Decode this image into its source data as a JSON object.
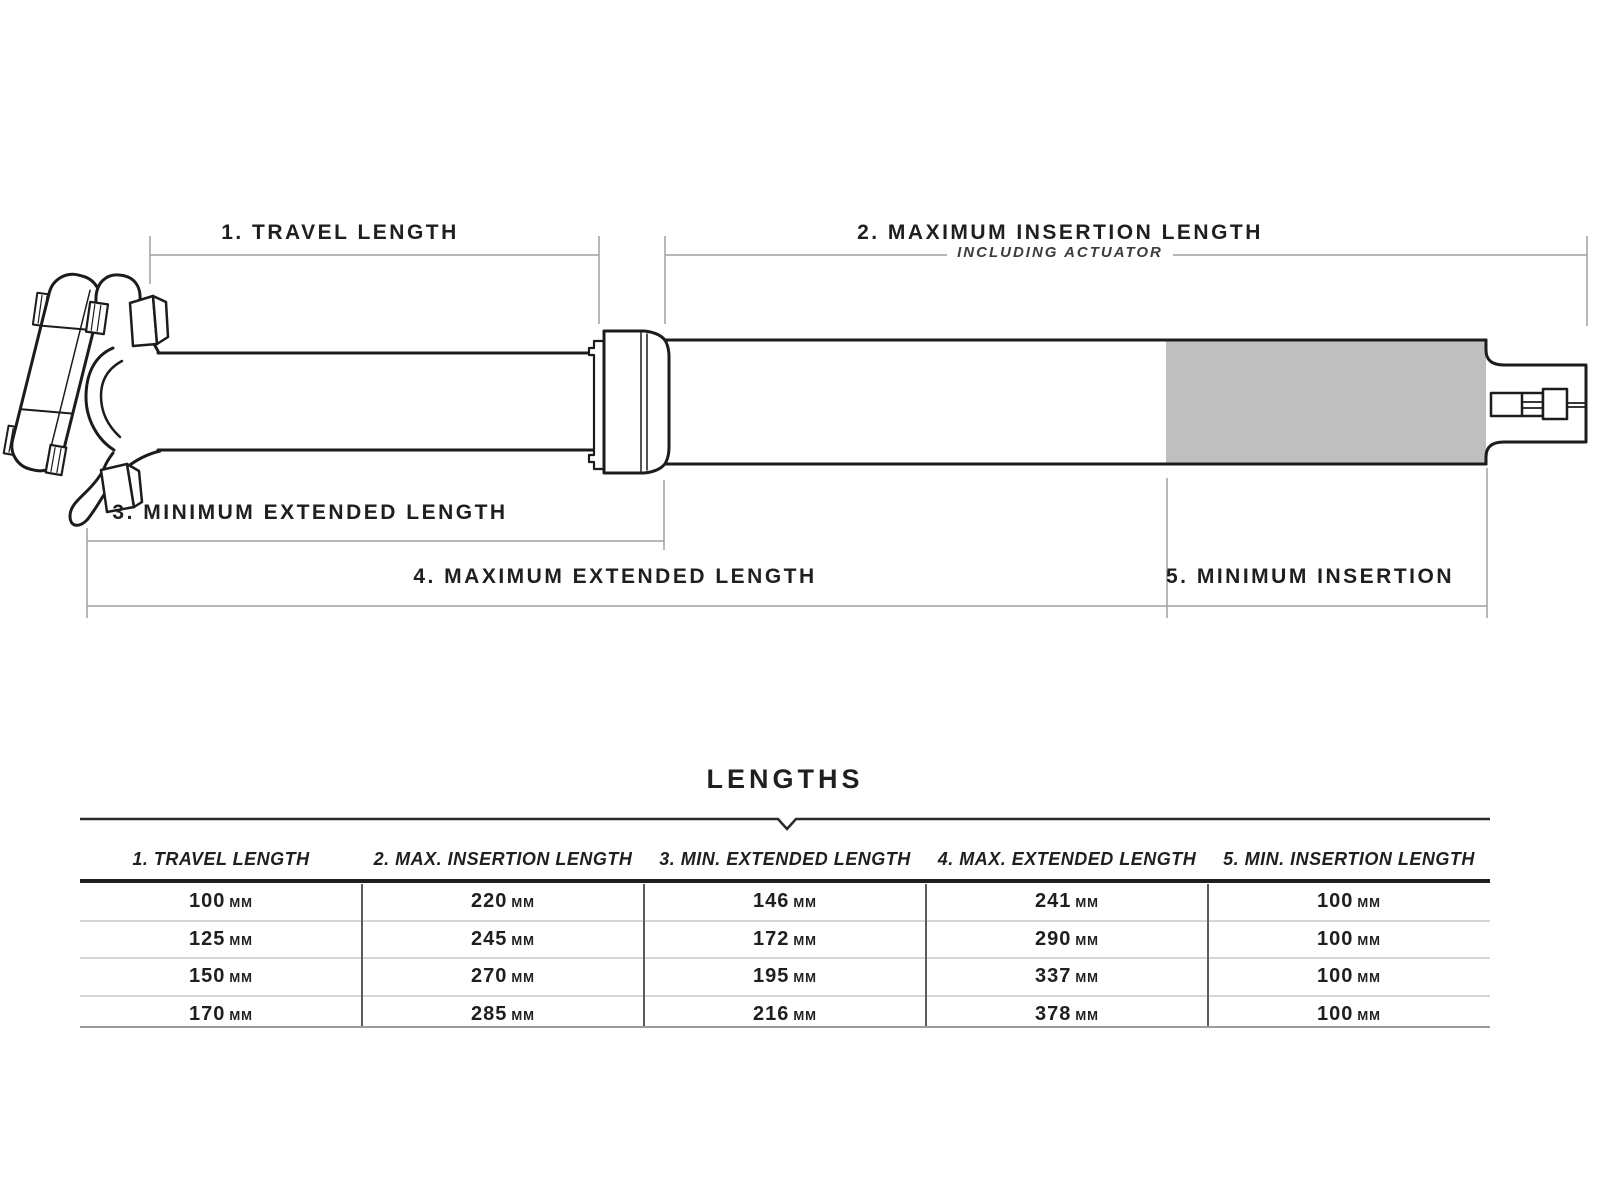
{
  "diagram": {
    "labels": {
      "travel": "1. TRAVEL LENGTH",
      "max_insertion": "2. MAXIMUM INSERTION LENGTH",
      "max_insertion_sub": "INCLUDING ACTUATOR",
      "min_extended": "3. MINIMUM EXTENDED LENGTH",
      "max_extended": "4. MAXIMUM EXTENDED LENGTH",
      "min_insertion": "5. MINIMUM INSERTION"
    },
    "colors": {
      "insertion_zone": "#bfbfbf",
      "outline": "#1c1c1c",
      "dimension_line": "#a0a0a0",
      "text": "#1f1f1f"
    }
  },
  "table": {
    "title": "LENGTHS",
    "unit": "MM",
    "headers": [
      "1. TRAVEL LENGTH",
      "2. MAX. INSERTION LENGTH",
      "3. MIN. EXTENDED LENGTH",
      "4. MAX. EXTENDED LENGTH",
      "5. MIN. INSERTION LENGTH"
    ],
    "rows": [
      [
        "100",
        "220",
        "146",
        "241",
        "100"
      ],
      [
        "125",
        "245",
        "172",
        "290",
        "100"
      ],
      [
        "150",
        "270",
        "195",
        "337",
        "100"
      ],
      [
        "170",
        "285",
        "216",
        "378",
        "100"
      ]
    ]
  }
}
